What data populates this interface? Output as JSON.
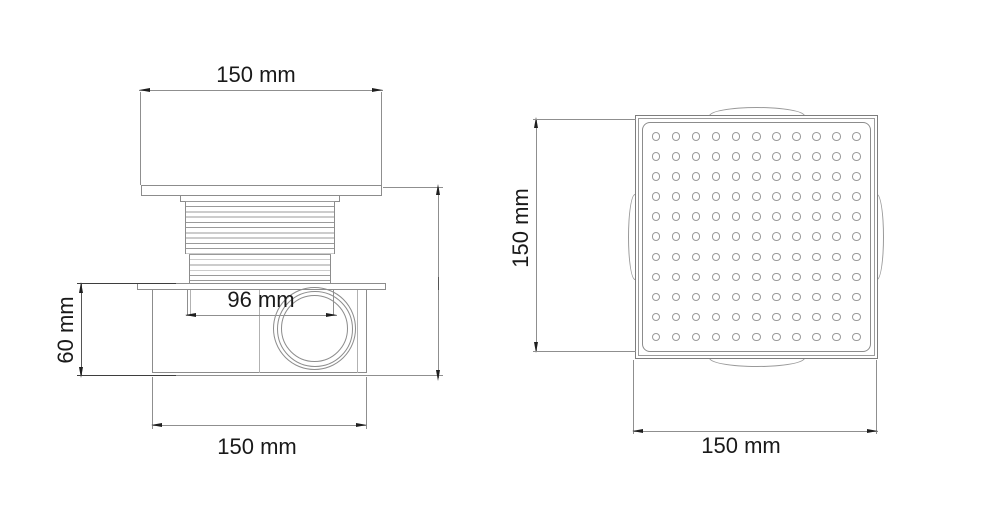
{
  "side_view": {
    "dim_top_width": "150 mm",
    "dim_inner_width": "96 mm",
    "dim_height": "60 mm",
    "dim_bottom_width": "150 mm"
  },
  "top_view": {
    "dim_height": "150 mm",
    "dim_width": "150 mm",
    "grate": {
      "rows": 11,
      "cols": 11,
      "hole_shape": "circle"
    }
  },
  "colors": {
    "object_line": "#8c8c8c",
    "dimension_line": "#8f8f8f",
    "dark_line": "#3e3e3e",
    "arrow": "#1f1f1f",
    "text": "#191919",
    "background": "#ffffff"
  }
}
